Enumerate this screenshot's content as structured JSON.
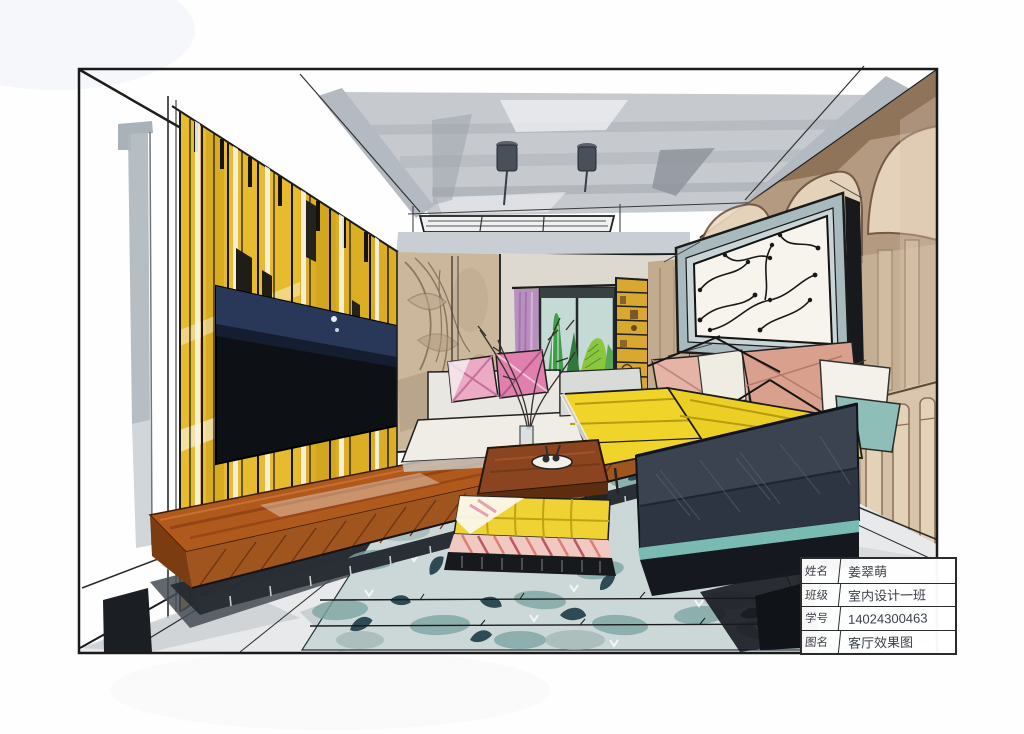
{
  "page": {
    "background_color": "#ffffff",
    "border_color": "#1a1a1a"
  },
  "title_block": {
    "rows": [
      {
        "label": "姓名",
        "value": "姜翠萌"
      },
      {
        "label": "班级",
        "value": "室内设计一班"
      },
      {
        "label": "学号",
        "value": "14024300463"
      },
      {
        "label": "图名",
        "value": "客厅效果图"
      }
    ]
  },
  "artwork": {
    "type": "hand-drawn marker rendering",
    "subject": "living room interior, one-point perspective",
    "elements": [
      "coffered ceiling with downlights and linear vent",
      "yellow slat feature wall",
      "wall-mounted tv",
      "wood media console",
      "textured mural wall",
      "purple curtain",
      "window with cactus plants",
      "yellow bookshelf",
      "framed branch artwork",
      "arched stone wall",
      "balustrade",
      "daybed with pink pillows",
      "yellow sectional sofa",
      "rose and teal throw pillows",
      "navy sofa with teal trim",
      "wood coffee table with vase and bowl",
      "yellow tufted ottoman with striped skirt",
      "patterned teal area rug",
      "grey tile floor"
    ],
    "palette": {
      "paper": "#fefefe",
      "ink": "#1c1c1c",
      "slat_yellow": "#e6bb2f",
      "tv_screen": "#10131a",
      "tv_glow": "#2c3d60",
      "console_wood": "#b0591d",
      "ceiling_grey": "#c6cacf",
      "mural_tan": "#cbb79c",
      "curtain_purple": "#b98fc0",
      "plant_green": "#3f9d4b",
      "bookshelf_gold": "#d8a831",
      "wall_brown": "#b39a80",
      "frame_blue_grey": "#a9babf",
      "sofa_yellow": "#f0d42a",
      "pillow_rose": "#d8a08d",
      "pillow_pink": "#ecaac4",
      "pillow_teal": "#8fbdb8",
      "navy_sofa": "#3b4350",
      "accent_teal": "#79bab3",
      "rug_base": "#ccd8d8",
      "rug_leaf": "#2e4b55",
      "floor_grey": "#e7e9ea"
    }
  }
}
